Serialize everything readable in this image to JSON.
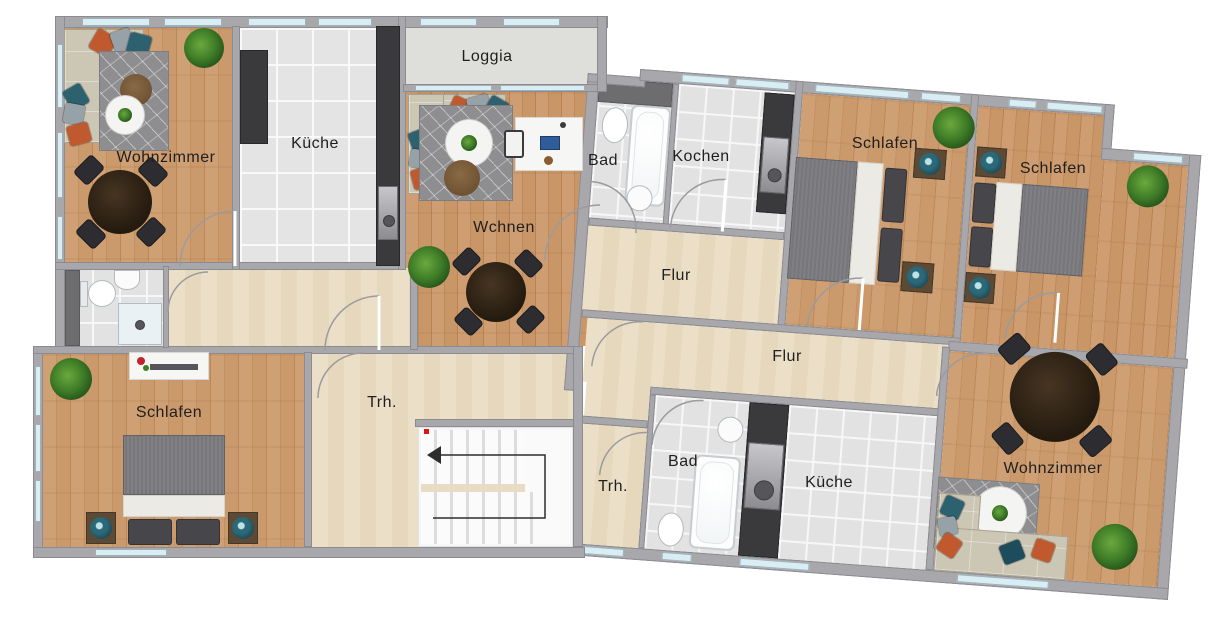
{
  "plan": {
    "type": "apartment floor plan",
    "language": "de",
    "stair_direction_arrow": "left"
  },
  "rooms": [
    {
      "id": "wohnzimmer-tl",
      "label": "Wohnzimmer",
      "x": 166,
      "y": 158,
      "floor": "wood"
    },
    {
      "id": "kueche-tl",
      "label": "Küche",
      "x": 315,
      "y": 144,
      "floor": "tile"
    },
    {
      "id": "loggia",
      "label": "Loggia",
      "x": 487,
      "y": 57,
      "floor": "concrete"
    },
    {
      "id": "wohnen-mitte",
      "label": "Wchnen",
      "x": 504,
      "y": 228,
      "floor": "wood"
    },
    {
      "id": "bad-top",
      "label": "Bad",
      "x": 603,
      "y": 161,
      "floor": "tile"
    },
    {
      "id": "kochen",
      "label": "Kochen",
      "x": 701,
      "y": 157,
      "floor": "tile"
    },
    {
      "id": "schlafen-1",
      "label": "Schlafen",
      "x": 885,
      "y": 144,
      "floor": "wood"
    },
    {
      "id": "schlafen-2",
      "label": "Schlafen",
      "x": 1053,
      "y": 169,
      "floor": "wood"
    },
    {
      "id": "flur-1",
      "label": "Flur",
      "x": 676,
      "y": 276,
      "floor": "screed"
    },
    {
      "id": "flur-2",
      "label": "Flur",
      "x": 787,
      "y": 357,
      "floor": "screed"
    },
    {
      "id": "schlafen-bl",
      "label": "Schlafen",
      "x": 169,
      "y": 413,
      "floor": "wood"
    },
    {
      "id": "treppenhaus-1",
      "label": "Trh.",
      "x": 382,
      "y": 403,
      "floor": "screed"
    },
    {
      "id": "treppenhaus-2",
      "label": "Trh.",
      "x": 613,
      "y": 487,
      "floor": "screed"
    },
    {
      "id": "bad-bottom",
      "label": "Bad",
      "x": 683,
      "y": 462,
      "floor": "tile"
    },
    {
      "id": "kueche-bottom",
      "label": "Küche",
      "x": 829,
      "y": 483,
      "floor": "tile"
    },
    {
      "id": "wohnzimmer-br",
      "label": "Wohnzimmer",
      "x": 1053,
      "y": 469,
      "floor": "wood"
    }
  ],
  "colors": {
    "wall": "#a8a8ac",
    "wood": "#c79465",
    "tile": "#e4e4e5",
    "hall": "#ecdfc8",
    "loggia": "#dededa",
    "window_glass": "#d8edf4",
    "kitchen_unit": "#3a3a3d",
    "smoke_detector": "#e01212",
    "plant": "#3f7d27",
    "lamp": "#2b6878"
  }
}
